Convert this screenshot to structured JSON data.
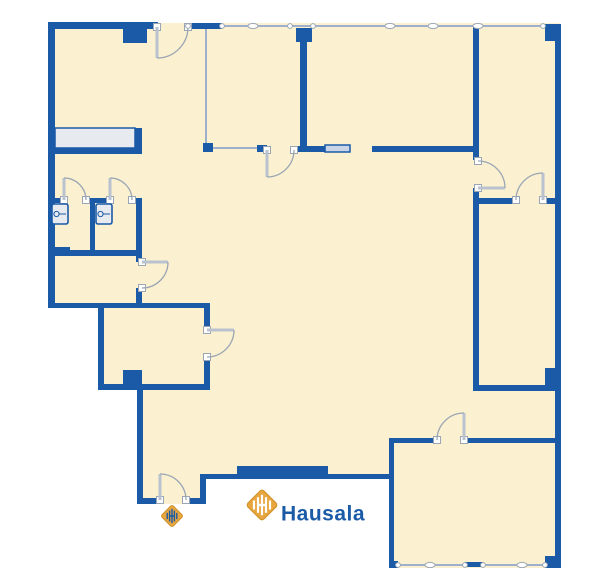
{
  "logo": {
    "text": "Hausala",
    "mark": "hausala-diamond-icon",
    "text_color": "#1B5AA7",
    "gold": "#E8A63E",
    "gold_dark": "#CE9027"
  },
  "colors": {
    "wall": "#1B5AA7",
    "floor": "#FBF0D0",
    "glass_line": "#9FB0CC",
    "arc": "#9AA6B4",
    "leaf": "#B9C2CE",
    "counter_fill": "#E7EAEF",
    "hatch_fill": "#C9D5E7",
    "cap_stroke": "#9AA6B4",
    "white": "#FFFFFF"
  },
  "floorplan": {
    "footprint": "48,23 560,23 560,568 390,568 390,479 206,479 206,504 137,504 137,390 98,390 98,308 48,308",
    "walls": [
      [
        48,
        22,
        110,
        7
      ],
      [
        48,
        22,
        7,
        286
      ],
      [
        188,
        23,
        34,
        6
      ],
      [
        296,
        28,
        16,
        14
      ],
      [
        300,
        28,
        7,
        124
      ],
      [
        123,
        29,
        24,
        14
      ],
      [
        545,
        24,
        16,
        17
      ],
      [
        555,
        24,
        6,
        544
      ],
      [
        295,
        146,
        30,
        6
      ],
      [
        372,
        146,
        105,
        6
      ],
      [
        473,
        27,
        6,
        133
      ],
      [
        473,
        188,
        6,
        203
      ],
      [
        473,
        198,
        41,
        6
      ],
      [
        543,
        198,
        18,
        6
      ],
      [
        478,
        385,
        83,
        6
      ],
      [
        545,
        368,
        13,
        17
      ],
      [
        389,
        438,
        48,
        5
      ],
      [
        465,
        438,
        93,
        5
      ],
      [
        389,
        438,
        5,
        130
      ],
      [
        389,
        561,
        9,
        7
      ],
      [
        545,
        556,
        16,
        12
      ],
      [
        200,
        474,
        189,
        5
      ],
      [
        237,
        466,
        91,
        13
      ],
      [
        200,
        474,
        6,
        30
      ],
      [
        137,
        498,
        23,
        6
      ],
      [
        188,
        498,
        18,
        6
      ],
      [
        137,
        388,
        6,
        116
      ],
      [
        98,
        308,
        6,
        82
      ],
      [
        98,
        384,
        112,
        6
      ],
      [
        204,
        308,
        6,
        19
      ],
      [
        204,
        357,
        6,
        33
      ],
      [
        48,
        303,
        162,
        5
      ],
      [
        123,
        370,
        19,
        16
      ],
      [
        48,
        148,
        94,
        6
      ],
      [
        135,
        128,
        7,
        26
      ],
      [
        48,
        198,
        16,
        5
      ],
      [
        87,
        198,
        23,
        5
      ],
      [
        133,
        198,
        9,
        5
      ],
      [
        90,
        203,
        5,
        47
      ],
      [
        136,
        198,
        6,
        52
      ],
      [
        48,
        250,
        94,
        6
      ],
      [
        48,
        247,
        22,
        9
      ],
      [
        136,
        256,
        6,
        6
      ],
      [
        136,
        288,
        6,
        20
      ],
      [
        203,
        143,
        10,
        9
      ],
      [
        257,
        145,
        10,
        7
      ],
      [
        465,
        562,
        18,
        5
      ]
    ],
    "thin_lines": [
      [
        188,
        26,
        543,
        26
      ],
      [
        206,
        27,
        206,
        147
      ],
      [
        213,
        148,
        257,
        148
      ],
      [
        394,
        565,
        545,
        565
      ]
    ],
    "window_boxes": [
      {
        "r": [
          55,
          128,
          80,
          20
        ],
        "fill": "counter_fill"
      },
      {
        "r": [
          325,
          145,
          25,
          7
        ],
        "fill": "hatch_fill"
      }
    ],
    "ellipse_markers": [
      [
        253,
        26
      ],
      [
        390,
        26
      ],
      [
        433,
        26
      ],
      [
        478,
        26
      ],
      [
        430,
        565
      ],
      [
        522,
        565
      ]
    ],
    "joint_dots": [
      [
        188,
        26
      ],
      [
        222,
        26
      ],
      [
        290,
        26
      ],
      [
        313,
        26
      ],
      [
        543,
        26
      ],
      [
        398,
        565
      ],
      [
        465,
        565
      ],
      [
        483,
        565
      ],
      [
        545,
        565
      ]
    ],
    "doors": [
      {
        "name": "door-top-entry",
        "leaf": [
          157,
          27,
          157,
          58
        ],
        "arc": [
          157,
          58,
          188,
          27,
          31,
          0
        ]
      },
      {
        "name": "door-topleft-room",
        "leaf": [
          267,
          150,
          267,
          177
        ],
        "arc": [
          267,
          177,
          294,
          150,
          27,
          0
        ]
      },
      {
        "name": "door-right-room-west",
        "leaf": [
          478,
          188,
          505,
          188
        ],
        "arc": [
          505,
          188,
          478,
          161,
          27,
          0
        ]
      },
      {
        "name": "door-right-rooms-link",
        "leaf": [
          543,
          200,
          543,
          173
        ],
        "arc": [
          543,
          173,
          516,
          200,
          27,
          0
        ]
      },
      {
        "name": "door-small-room-east",
        "leaf": [
          207,
          330,
          234,
          330
        ],
        "arc": [
          234,
          330,
          207,
          357,
          27,
          1
        ]
      },
      {
        "name": "door-storage-east",
        "leaf": [
          142,
          262,
          168,
          262
        ],
        "arc": [
          168,
          262,
          142,
          288,
          26,
          1
        ]
      },
      {
        "name": "door-wc-left",
        "leaf": [
          64,
          200,
          64,
          178
        ],
        "arc": [
          64,
          178,
          86,
          200,
          22,
          1
        ]
      },
      {
        "name": "door-wc-right",
        "leaf": [
          110,
          200,
          110,
          178
        ],
        "arc": [
          110,
          178,
          132,
          200,
          22,
          1
        ]
      },
      {
        "name": "door-bottomright-room",
        "leaf": [
          464,
          440,
          464,
          413
        ],
        "arc": [
          464,
          413,
          437,
          440,
          27,
          0
        ]
      },
      {
        "name": "door-main-entrance",
        "leaf": [
          160,
          500,
          160,
          474
        ],
        "arc": [
          160,
          474,
          186,
          500,
          26,
          1
        ]
      }
    ],
    "fixtures": [
      [
        52,
        204,
        16,
        20
      ],
      [
        96,
        204,
        16,
        20
      ]
    ],
    "logo_mark": {
      "cx": 262,
      "cy": 505,
      "r": 15
    },
    "entrance_mark": {
      "cx": 172,
      "cy": 516,
      "r": 10.5
    },
    "logo_text_pos": {
      "x": 281,
      "y": 513,
      "size": 21
    }
  }
}
